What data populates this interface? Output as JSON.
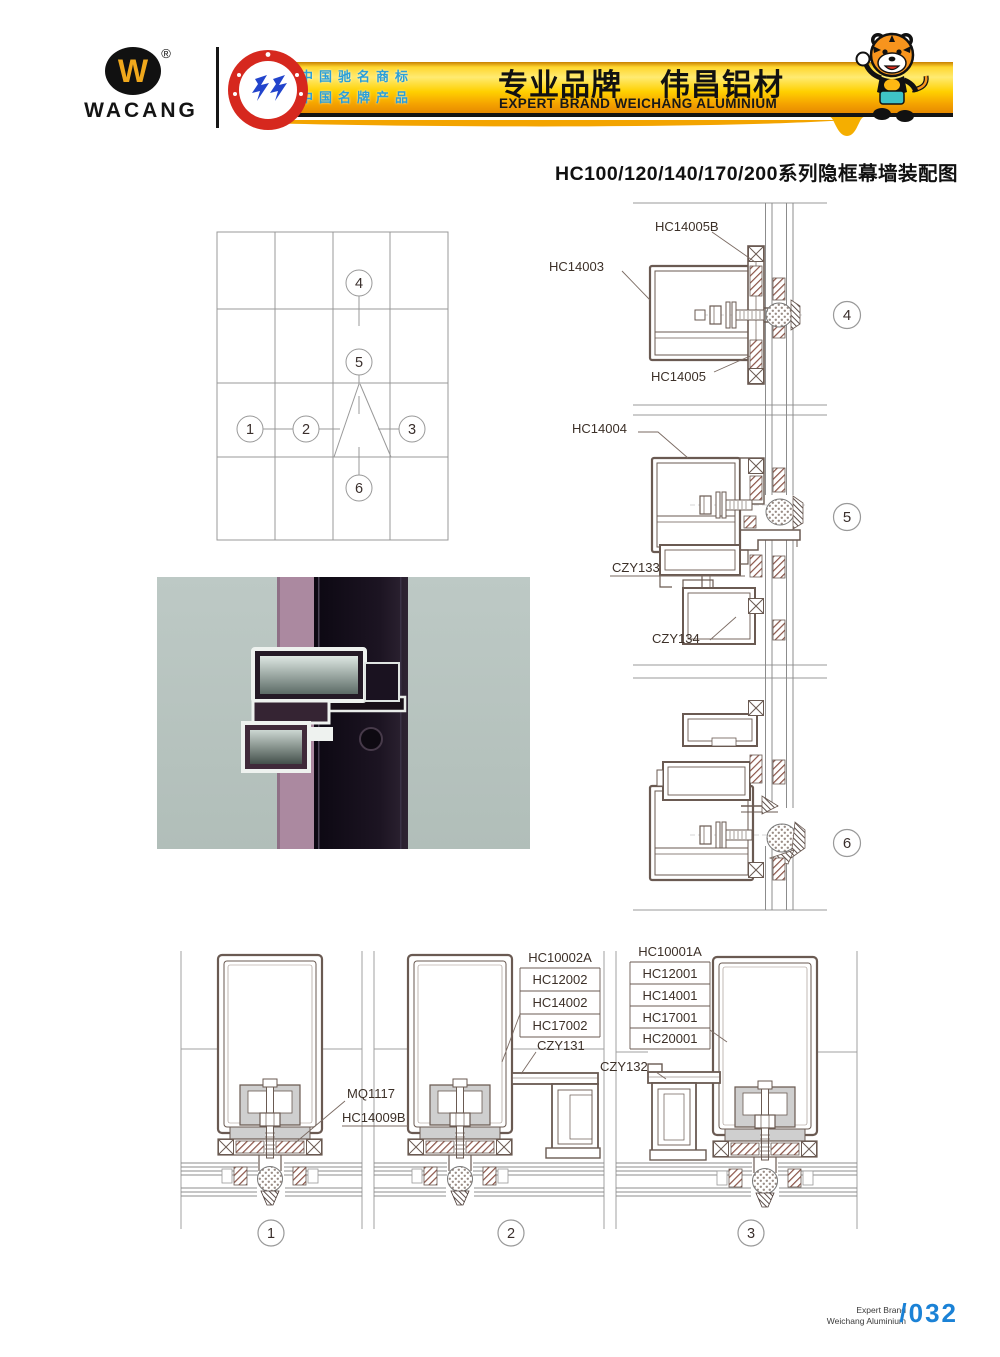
{
  "header": {
    "brand": "WACANG",
    "registered_mark": "®",
    "badge_text": "CHINA TOP BRAND",
    "cn_line1": "中国驰名商标",
    "cn_line2": "中国名牌产品",
    "slogan_cn": "专业品牌",
    "brand_cn": "伟昌铝材",
    "slogan_en": "EXPERT BRAND WEICHANG ALUMINIUM"
  },
  "page_title": "HC100/120/140/170/200系列隐框幕墙装配图",
  "callouts": [
    "1",
    "2",
    "3",
    "4",
    "5",
    "6"
  ],
  "labels": {
    "d4_top": "HC14005B",
    "d4_left": "HC14003",
    "d4_bottom": "HC14005",
    "d5_top": "HC14004",
    "d5_mid": "CZY133",
    "d5_bottom": "CZY134",
    "d1_line1": "MQ1117",
    "d1_line2": "HC14009B",
    "d2_stack": [
      "HC10002A",
      "HC12002",
      "HC14002",
      "HC17002"
    ],
    "d2_part": "CZY131",
    "d3_stack": [
      "HC10001A",
      "HC12001",
      "HC14001",
      "HC17001",
      "HC20001"
    ],
    "d3_part": "CZY132"
  },
  "footer": {
    "en_line1": "Expert Brand",
    "en_line2": "Weichang Aluminium",
    "page_no": "/032"
  },
  "colors": {
    "banner_yellow": "#ffd000",
    "accent_blue": "#1b82d6",
    "badge_red": "#d6281e",
    "text_blue": "#2a9fd8",
    "drawing_line": "#6a5a52"
  }
}
